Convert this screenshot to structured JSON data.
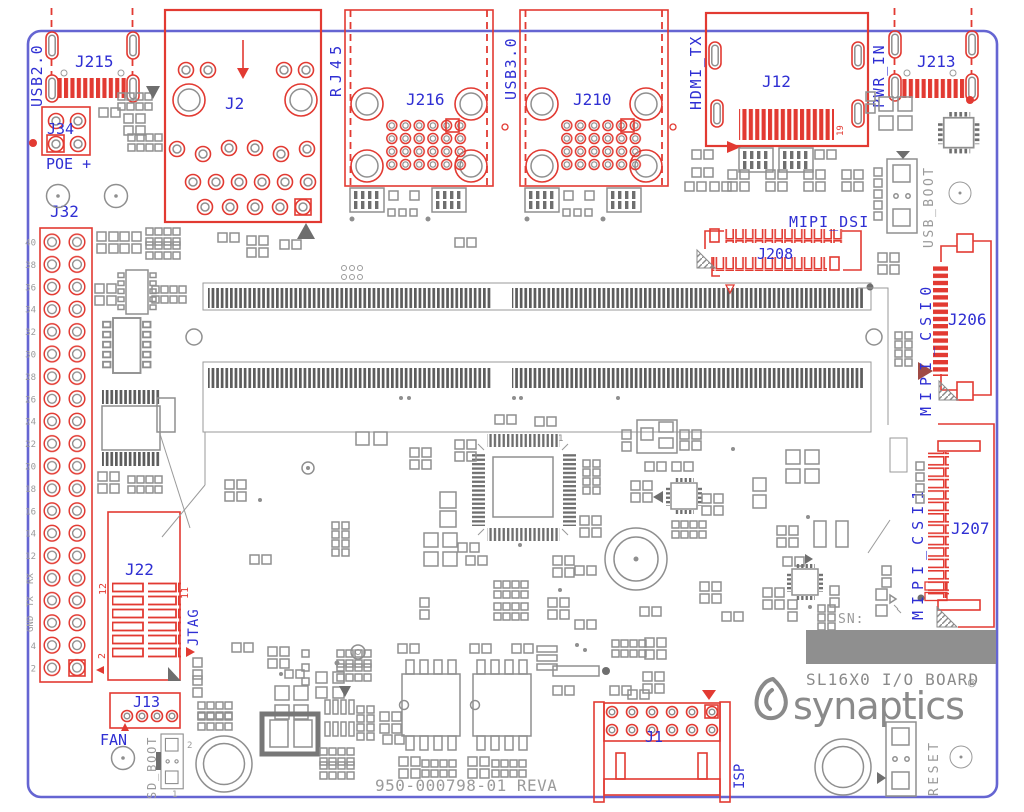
{
  "board": {
    "part_number": "950-000798-01 REVA",
    "product_name": "SL16X0 I/O BOARD",
    "brand": "synaptics",
    "brand_reg": "®",
    "serial_prefix": "SN:",
    "outline_color": "#6565d2",
    "silk_red": "#e23a32",
    "silk_gray": "#8f8f8f",
    "label_blue": "#2f2fd3"
  },
  "connectors": {
    "j215": {
      "ref": "J215",
      "function": "USB2.0"
    },
    "j34": {
      "ref": "J34",
      "function": "POE +"
    },
    "j32": {
      "ref": "J32",
      "pin_labels": [
        "40",
        "38",
        "36",
        "34",
        "32",
        "30",
        "28",
        "26",
        "24",
        "22",
        "20",
        "18",
        "16",
        "14",
        "12",
        "RX",
        "TX",
        "GND",
        "4",
        "2"
      ]
    },
    "j2": {
      "ref": "J2",
      "function": "RJ45"
    },
    "j216": {
      "ref": "J216"
    },
    "j210": {
      "ref": "J210",
      "function": "USB3.0"
    },
    "j12": {
      "ref": "J12",
      "function": "HDMI_TX",
      "pin19": "19"
    },
    "j213": {
      "ref": "J213",
      "function": "PWR_IN"
    },
    "j208": {
      "ref": "J208",
      "function": "MIPI_DSI"
    },
    "j206": {
      "ref": "J206",
      "function": "MIPI_CSI0"
    },
    "j207": {
      "ref": "J207",
      "function": "MIPI_CSI1"
    },
    "j22": {
      "ref": "J22",
      "function": "JTAG",
      "pin12": "12",
      "pin2": "2",
      "pin11": "11"
    },
    "j13": {
      "ref": "J13",
      "function": "FAN"
    },
    "j1": {
      "ref": "J1",
      "function": "ISP"
    }
  },
  "switches": {
    "usb_boot": "USB_BOOT",
    "sd_boot": "SD_BOOT",
    "sd_boot_pin2": "2",
    "sd_boot_pin1": "1",
    "reset": "RESET"
  },
  "ic_markings": {
    "qfp_pin1": "1"
  }
}
